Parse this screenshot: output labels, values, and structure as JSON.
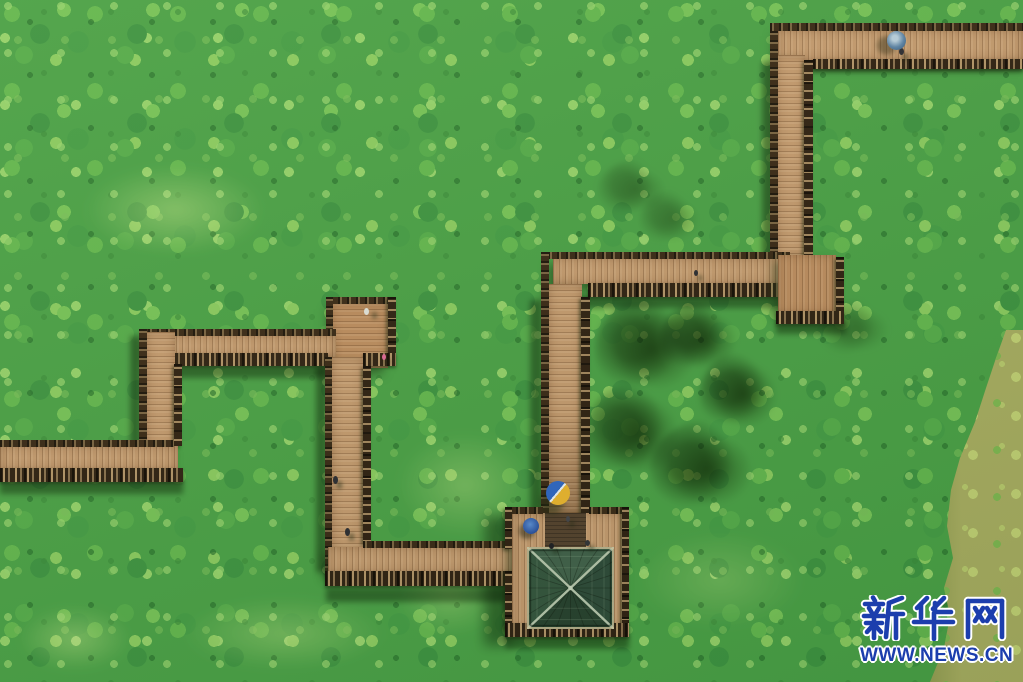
{
  "scene": {
    "description": "Aerial drone view of zigzag wooden boardwalks winding through a dense green lotus pond, with a square pavilion (dark green hip roof) at the bottom center, visitors with umbrellas on the walkways, and an olive water channel along the right edge",
    "lotus_field_color": "#4aa047",
    "boardwalk_color": "#c59a70",
    "railing_color": "#2f2013",
    "pavilion_roof_color": "#2e4a3a",
    "water_channel_color": "#a9ad62",
    "people_visible": 9,
    "umbrellas": [
      {
        "location": "top-right boardwalk",
        "color": "blue-grey"
      },
      {
        "location": "walkway above pavilion",
        "color": "blue and yellow"
      },
      {
        "location": "pavilion deck",
        "color": "blue"
      }
    ]
  },
  "watermark": {
    "brand": "新华网",
    "url": "WWW.NEWS.CN",
    "text_color": "#1c3ead",
    "outline_color": "#ffffff"
  }
}
